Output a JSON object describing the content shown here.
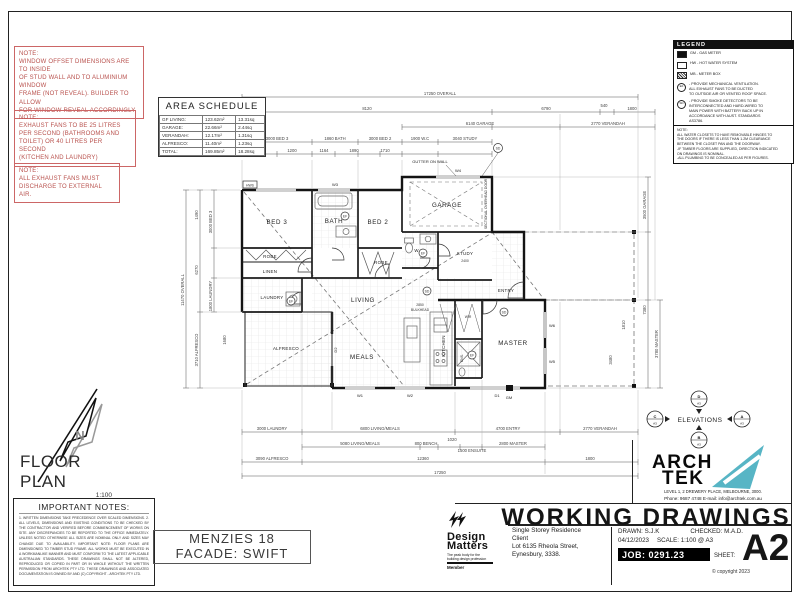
{
  "colors": {
    "red": "#b8504c",
    "teal": "#57b5c5",
    "black": "#111111"
  },
  "notes_red": [
    "NOTE:\nWINDOW OFFSET DIMENSIONS ARE TO INSIDE\nOF STUD WALL AND TO ALUMINIUM WINDOW\nFRAME (NOT REVEAL). BUILDER TO ALLOW\nFOR WINDOW REVEAL ACCORDINGLY",
    "NOTE:\nEXHAUST FANS TO BE 25 LITRES\nPER SECOND (BATHROOMS AND\nTOILET) OR 40 LITRES PER SECOND\n(KITCHEN AND LAUNDRY)",
    "NOTE:\nALL EXHAUST FANS MUST\nDISCHARGE TO EXTERNAL\nAIR."
  ],
  "area_schedule": {
    "title": "AREA SCHEDULE",
    "rows": [
      {
        "name": "GF LIVING:",
        "m2": "123.62m²",
        "sq": "13.31sq"
      },
      {
        "name": "GARAGE:",
        "m2": "22.66m²",
        "sq": "2.44sq"
      },
      {
        "name": "VERANDAH:",
        "m2": "12.17m²",
        "sq": "1.31sq"
      },
      {
        "name": "ALFRESCO:",
        "m2": "11.40m²",
        "sq": "1.23sq"
      },
      {
        "name": "TOTAL:",
        "m2": "169.85m²",
        "sq": "18.28sq"
      }
    ]
  },
  "legend": {
    "title": "LEGEND",
    "items": [
      {
        "sym": "GM",
        "label": "GM  -  GAS METER"
      },
      {
        "sym": "HW",
        "label": "HW  -  HOT WATER SYSTEM"
      },
      {
        "sym": "MB",
        "label": "MB  -  METER BOX"
      },
      {
        "sym": "EF",
        "label": "-  PROVIDE MECHANICAL VENTILATION.\nALL EXHAUST FANS TO BE DUCTED\nTO OUTSIDE AIR OR VENTED ROOF SPACE."
      },
      {
        "sym": "SD",
        "label": "-  PROVIDE SMOKE DETECTORS TO BE\nINTERCONNECTED AND HARD-WIRED TO\nMAIN POWER WITH BATTERY BACK UP IN\nACCORDANCE WITH AUST. STANDARDS\nAS3786."
      }
    ],
    "note": "NOTE:\nALL WATER CLOSETS TO HAVE REMOVABLE HINGES TO\nTHE DOORS IF THERE IS LESS THAN 1.2M CLEARANCE\nBETWEEN THE CLOSET PAN AND THE DOORWAY.\n-IF TIMBER FLOORS ARE SUPPLIED, DIRECTION INDICATED\nON DRAWINGS IS NOMINAL.\n-ALL PLUMBING TO BE CONCEALED AS PER FIGURES."
  },
  "plan": {
    "rooms": {
      "bed3": "BED 3",
      "bath": "BATH",
      "bed2": "BED 2",
      "robe1": "ROBE",
      "robe2": "ROBE",
      "linen": "LINEN",
      "laundry": "LAUNDRY",
      "living": "LIVING",
      "meals": "MEALS",
      "kitchen": "KITCHEN",
      "alfresco": "ALFRESCO",
      "garage": "GARAGE",
      "wc": "W.C",
      "study": "STUDY",
      "study_size": "2400",
      "entry": "ENTRY",
      "master": "MASTER",
      "ens": "ENS.",
      "wir": "WIR"
    },
    "labels": {
      "gutter": "GUTTER ON WALL",
      "bulkhead1": "2850",
      "bulkhead2": "BULKHEAD",
      "garage_door": "SECTIONAL OVERHEAD DOOR",
      "hws": "HWS",
      "gm": "GM",
      "sd": "SD",
      "ef": "EF",
      "w1": "W1",
      "w2": "W2",
      "w3": "W3",
      "w4": "W4",
      "w5": "W5",
      "w6": "W6",
      "d1": "D1",
      "d2": "D2"
    },
    "dims_top": [
      "17250 OVERALL",
      "8120",
      "6790",
      "540",
      "1800",
      "6140 GARAGE",
      "2770 VERANDAH",
      "3000 BED 3",
      "1860 BATH",
      "3000 BED 2",
      "1900 W.C",
      "3040 STUDY",
      "1710",
      "1200",
      "1164",
      "1890",
      "1710"
    ],
    "dims_bottom": [
      "3000 LAUNDRY",
      "6800 LIVING/MEALS",
      "4700 ENTRY",
      "2770 VERANDAH",
      "5080 LIVING/MEALS",
      "800 BENCH",
      "1020",
      "1500 ENSUITE",
      "2800 MASTER",
      "3090 ALFRESCO",
      "12360",
      "1800",
      "17250"
    ],
    "dims_left": [
      "11470 OVERALL",
      "1490",
      "6270",
      "3710 ALFRESCO",
      "3000 BED 3",
      "1800 LAUNDRY",
      "1680"
    ],
    "dims_right": [
      "3500 GARAGE",
      "7380",
      "1810",
      "3780 MASTER",
      "3480"
    ]
  },
  "north": {
    "n": "N"
  },
  "floorplan_label": {
    "title": "FLOOR PLAN",
    "scale": "1:100"
  },
  "important_notes": {
    "title": "IMPORTANT NOTES:",
    "body": "1. WRITTEN DIMENSIONS TAKE PRECEDENCE OVER SCALED DIMENSIONS. 2. ALL LEVELS, DIMENSIONS AND EXISTING CONDITIONS TO BE CHECKED BY THE CONTRACTOR AND VERIFIED BEFORE COMMENCEMENT OF WORKS ON SITE. ANY DISCREPANCIES TO BE REPORTED TO THE OFFICE IMMEDIATELY. UNLESS NOTED OTHERWISE ALL SIZES ARE NOMINAL ONLY AND SIZES MAY CHANGE DUE TO AVAILABILITY. IMPORTANT NOTE: FLOOR PLANS ARE DIMENSIONED TO TIMBER STUD FRAME. ALL WORKS MUST BE EXECUTED IN A WORKMANLIKE MANNER AND MUST CONFORM TO THE LATEST APPLICABLE AUSTRALIAN STANDARDS. THESE DRAWINGS SHALL NOT BE ALTERED, REPRODUCED OR COPIED IN PART OR IN WHOLE WITHOUT THE WRITTEN PERMISSION FROM ARCHTEK PTY LTD. THESE DRAWINGS AND ASSOCIATED DOCUMENTATION IS OWNED BY AND (C) COPYRIGHT - ARCHTEK PTY LTD."
  },
  "facade_box": {
    "line1": "MENZIES 18",
    "line2": "FACADE: SWIFT"
  },
  "design_matters": {
    "name_top": "Design",
    "name_bottom": "Matters",
    "tagline": "The peak body for the\nbuilding design profession",
    "member": "Member"
  },
  "titleblock": {
    "logo_top": "ARCH",
    "logo_bottom": "TEK",
    "address": "LEVEL 1, 2 DREWERY PLACE, MELBOURNE, 3000.",
    "phone": "Phone: 9687 4748 E-mail: info@archtek.com.au",
    "heading": "WORKING DRAWINGS",
    "project_line1": "Single Storey Residence",
    "project_line2": "Client",
    "project_line3": "Lot 6135 Rheola Street,",
    "project_line4": "Eynesbury, 3338.",
    "drawn": "DRAWN:  S.J.K",
    "checked": "CHECKED: M.A.D.",
    "date": "04/12/2023",
    "scale": "SCALE:  1:100 @ A3",
    "job": "JOB:  0291.23",
    "sheet_label": "SHEET:",
    "sheet": "A2",
    "copyright": "© copyright 2023"
  },
  "elevations": {
    "label": "ELEVATIONS",
    "top": "D",
    "bottom": "B",
    "left": "C",
    "right": "A",
    "sheet": "A3"
  }
}
